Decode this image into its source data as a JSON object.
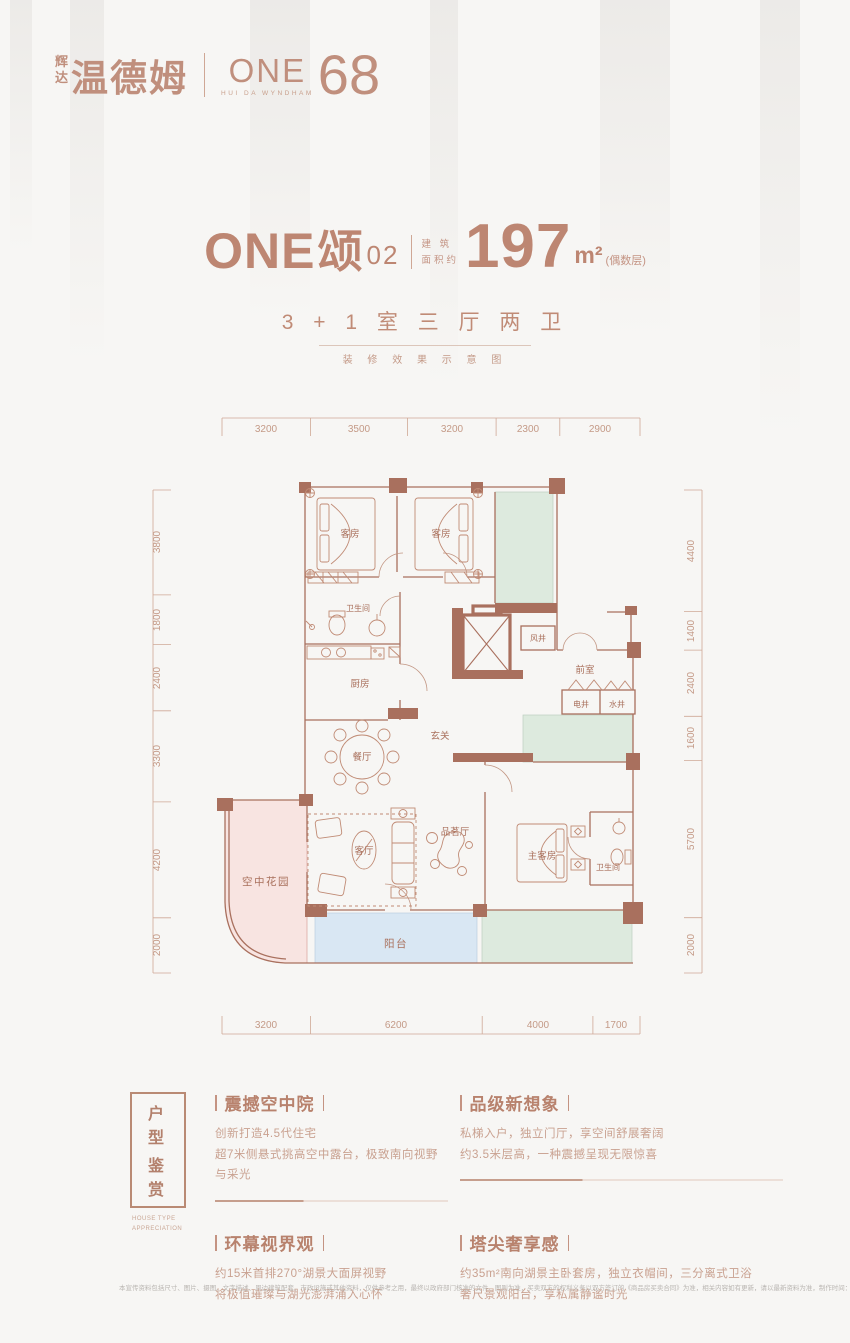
{
  "brand": {
    "name_small_1": "辉",
    "name_small_2": "达",
    "name_large": "温德姆",
    "logo_main": "ONE",
    "logo_number": "68",
    "logo_caption": "HUI DA  WYNDHAM"
  },
  "title": {
    "prefix": "ONE",
    "cn": "颂",
    "unit_no": "02",
    "area_label_top": "建 筑",
    "area_label_bottom": "面积约",
    "area_value": "197",
    "area_unit": "m²",
    "area_note": "(偶数层)",
    "layout": "3 + 1 室 三 厅 两 卫",
    "caption": "装 修 效 果 示 意 图"
  },
  "floorplan": {
    "dims_top": [
      "3200",
      "3500",
      "3200",
      "2300",
      "2900"
    ],
    "dims_bottom": [
      "3200",
      "6200",
      "4000",
      "1700"
    ],
    "dims_left": [
      "3800",
      "1800",
      "2400",
      "3300",
      "4200",
      "2000"
    ],
    "dims_right": [
      "4400",
      "1400",
      "2400",
      "1600",
      "5700",
      "2000"
    ],
    "rooms": {
      "guest_room_1": "客房",
      "guest_room_2": "客房",
      "bathroom_upper": "卫生间",
      "kitchen": "厨房",
      "dining_room": "餐厅",
      "foyer": "玄关",
      "air_shaft": "风井",
      "front_room": "前室",
      "electric_shaft": "电井",
      "water_shaft": "水井",
      "sky_garden": "空中花园",
      "living_room": "客厅",
      "tea_room": "品茗厅",
      "master_room": "主客房",
      "bathroom_lower": "卫生间",
      "balcony": "阳台"
    }
  },
  "badge": {
    "title_row1": "户 型",
    "title_row2": "鉴 赏",
    "subtitle_row1": "HOUSE TYPE",
    "subtitle_row2": "APPRECIATION"
  },
  "features": [
    {
      "title": "震撼空中院",
      "line1": "创新打造4.5代住宅",
      "line2": "超7米侧悬式挑高空中露台，极致南向视野与采光"
    },
    {
      "title": "品级新想象",
      "line1": "私梯入户，独立门厅，享空间舒展奢阔",
      "line2": "约3.5米层高，一种震撼呈现无限惊喜"
    },
    {
      "title": "环幕视界观",
      "line1": "约15米首排270°湖景大面屏视野",
      "line2": "将极值璀璨与湖光澎湃涌入心怀"
    },
    {
      "title": "塔尖奢享感",
      "line1": "约35m²南向湖景主卧套房，独立衣帽间，三分离式卫浴",
      "line2": "奢尺景观阳台，享私属静谧时光"
    }
  ],
  "footer": {
    "disclaimer": "本宣传资料包括尺寸、图片、摄图、文字描述、周边建筑配套、市政设施或其他资料，仅供参考之用，最终以政府部门核准的文件、图则为准，买卖双方的权利义务以双方签订的《商品房买卖合同》为准，相关内容如有更新，请以最新资料为准，制作时间：2024年1月"
  },
  "colors": {
    "accent": "#bd8672",
    "wall": "#a9705e",
    "dim_text": "#c49a87",
    "green_area": "#ddeade",
    "pink_area": "#f8e4e1",
    "blue_area": "#d9e7f3",
    "body_text": "#c9a190"
  }
}
